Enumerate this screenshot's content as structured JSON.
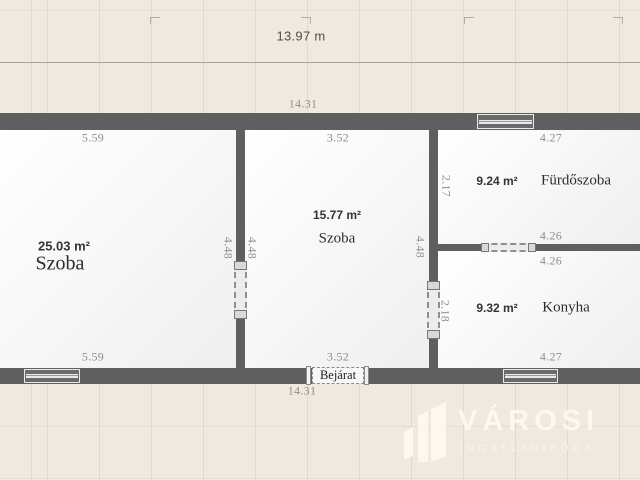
{
  "header": {
    "total_width_label": "13.97 m"
  },
  "plan": {
    "outer_dims": {
      "top": "14.31",
      "bottom": "14.31"
    },
    "entrance": {
      "label": "Bejárat"
    },
    "rooms": [
      {
        "name": "Szoba",
        "area": "25.03 m²",
        "dim_top": "5.59",
        "dim_bottom": "5.59",
        "dim_right": "4.48"
      },
      {
        "name": "Szoba",
        "area": "15.77 m²",
        "dim_top": "3.52",
        "dim_bottom": "3.52",
        "dim_left": "4.48",
        "dim_right": "4.48"
      },
      {
        "name": "Fürdőszoba",
        "area": "9.24 m²",
        "dim_top": "4.27",
        "dim_bottom": "4.26",
        "dim_left": "2.17"
      },
      {
        "name": "Konyha",
        "area": "9.32 m²",
        "dim_top": "4.26",
        "dim_bottom": "4.27",
        "dim_left": "2.18"
      }
    ]
  },
  "watermark": {
    "brand": "VÁROSI",
    "tagline": "INGATLANIRODA",
    "icon": "buildings-icon"
  },
  "colors": {
    "background": "#efe9e0",
    "wall": "#5f5f5f",
    "room_fill": "#fafafa",
    "dimension_text": "#8e8e8e",
    "label_text": "#2d2d2d",
    "logo": "#fcf8ee"
  }
}
